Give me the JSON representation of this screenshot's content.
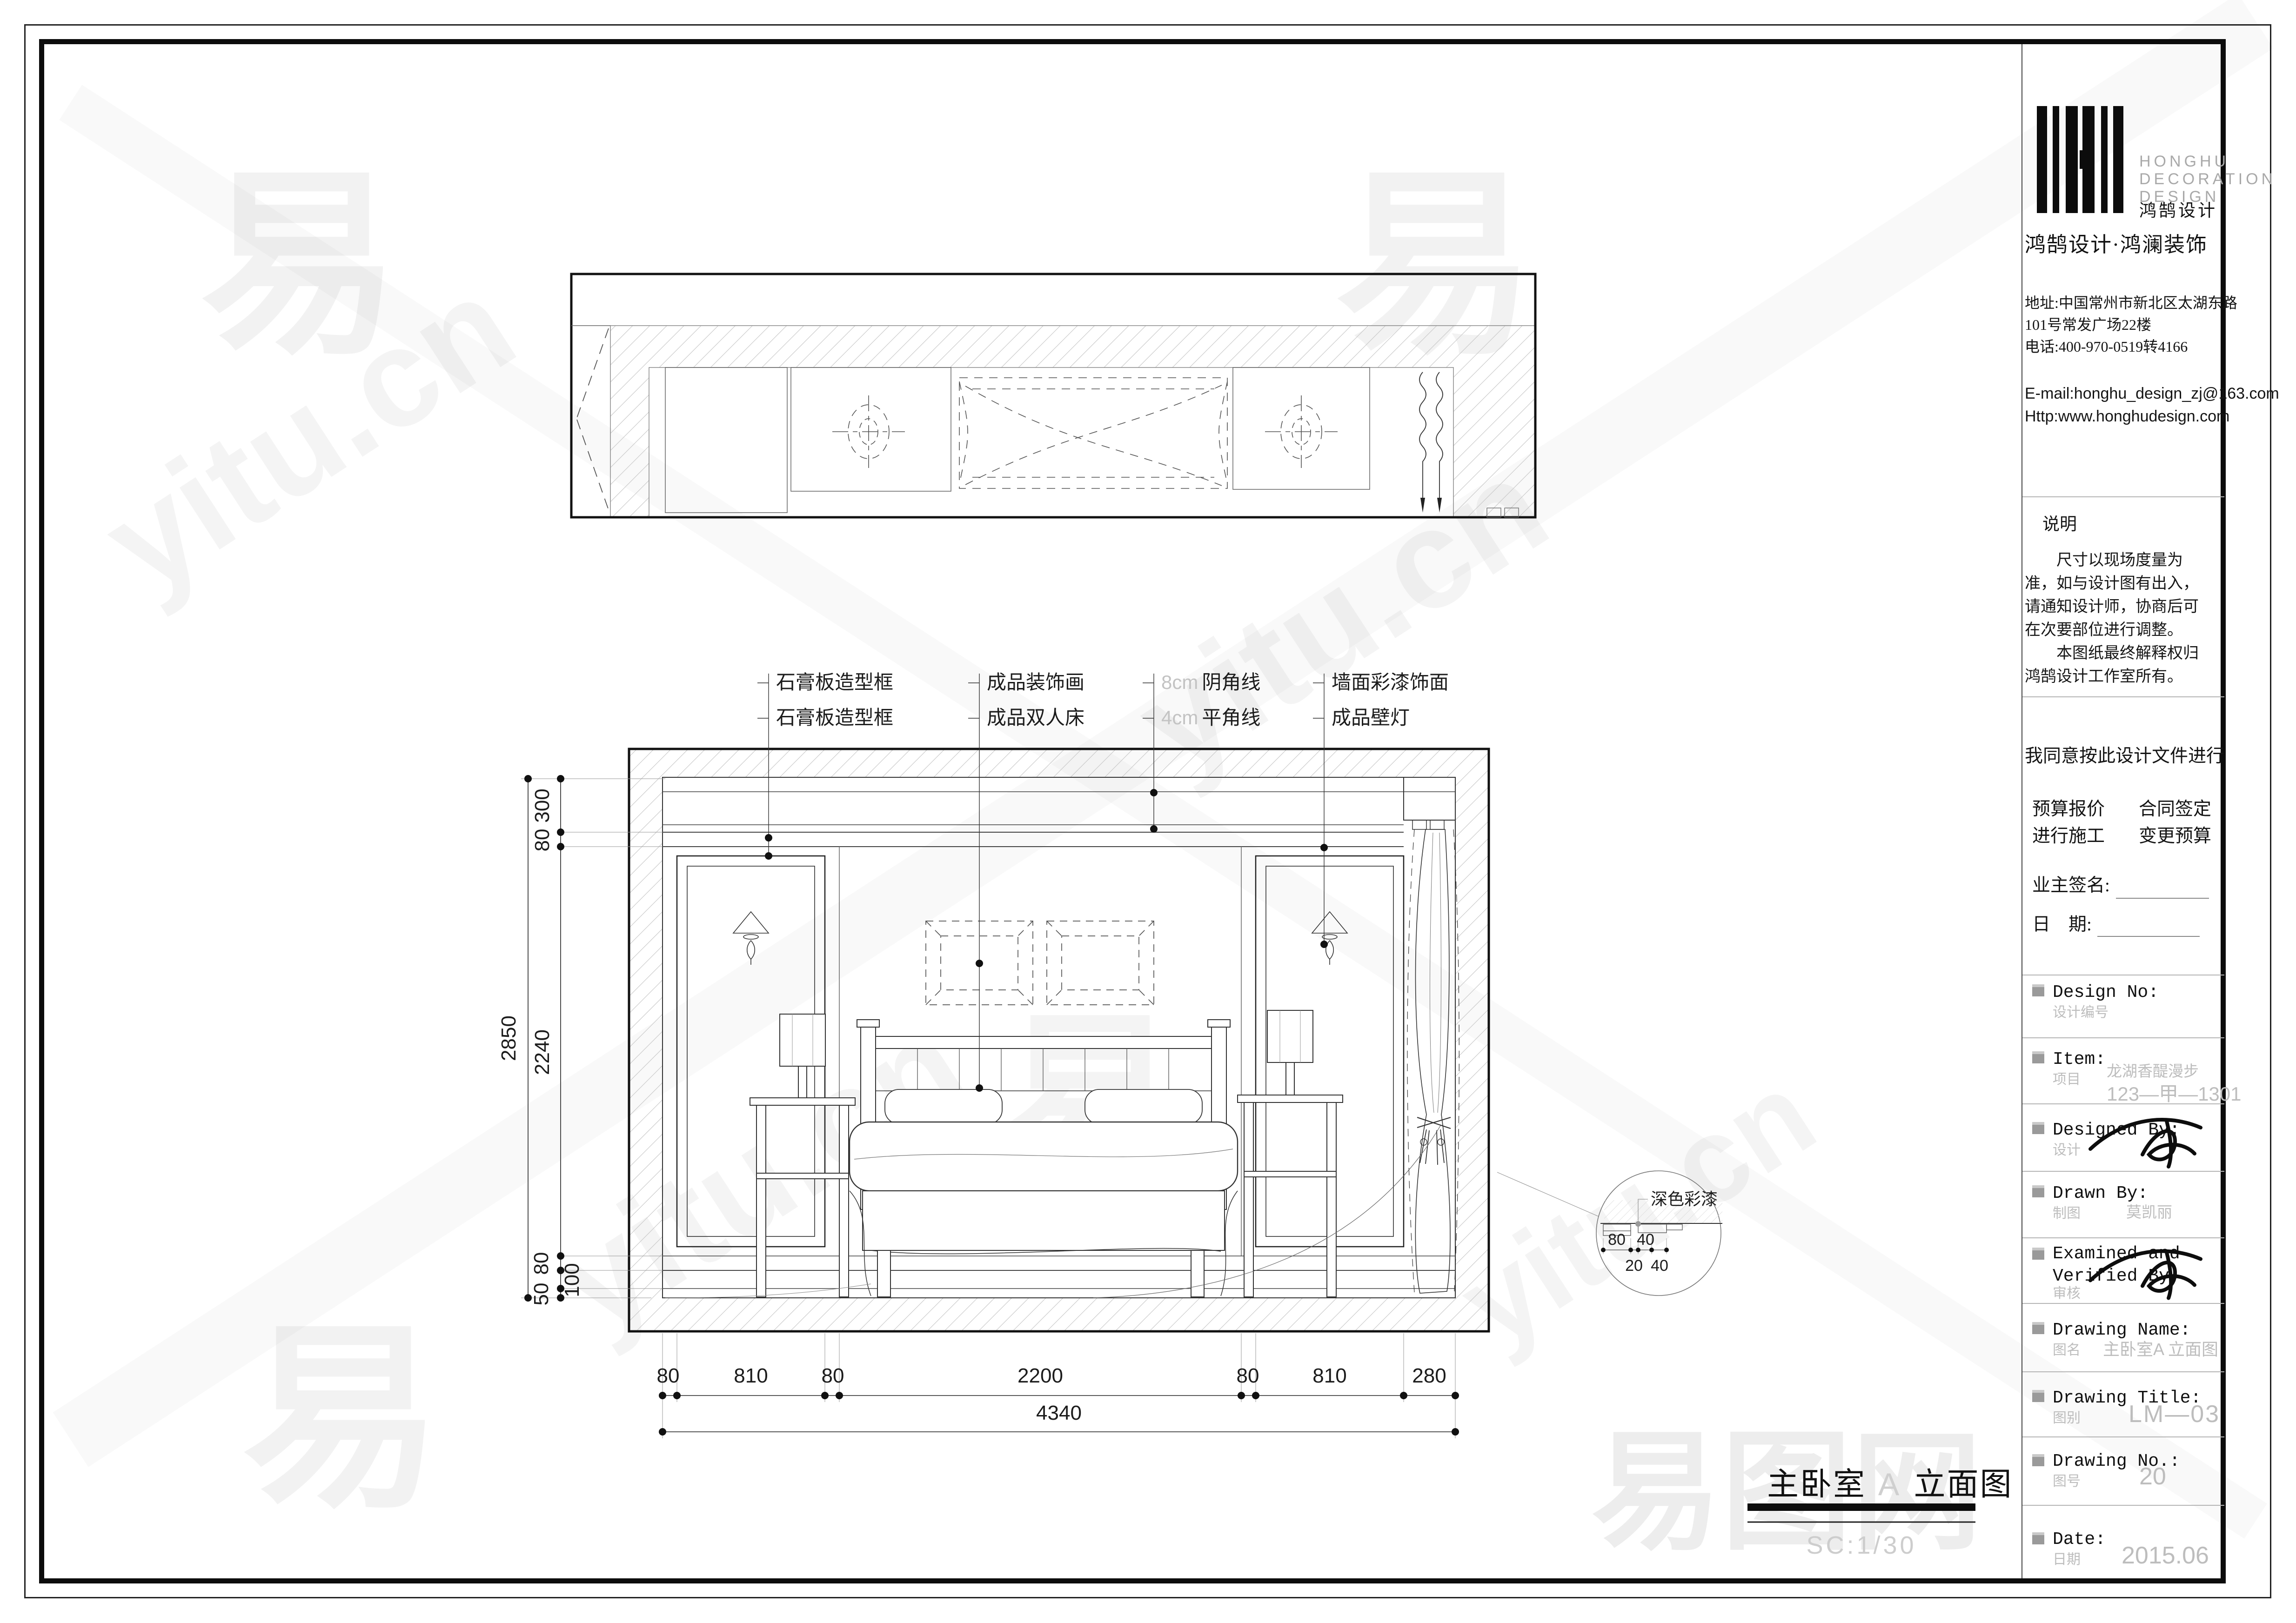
{
  "company": {
    "name_en1": "HONGHU",
    "name_en2": "DECORATION",
    "name_en3": "DESIGN",
    "name_cn": "鸿鹄设计",
    "brand_line": "鸿鹄设计·鸿澜装饰",
    "address1": "地址:中国常州市新北区太湖东路",
    "address2": "101号常发广场22楼",
    "phone": "电话:400-970-0519转4166",
    "email": "E-mail:honghu_design_zj@163.com",
    "website": "Http:www.honghudesign.com"
  },
  "notes": {
    "heading": "说明",
    "para1": "尺寸以现场度量为准，如与设计图有出入，请通知设计师，协商后可在次要部位进行调整。",
    "para2": "本图纸最终解释权归鸿鹄设计工作室所有。"
  },
  "agreement": {
    "line": "我同意按此设计文件进行",
    "opt1": "预算报价",
    "opt2": "合同签定",
    "opt3": "进行施工",
    "opt4": "变更预算",
    "sign_label": "业主签名:",
    "date_label": "日    期:"
  },
  "fields": {
    "design_no": {
      "en": "Design No:",
      "cn": "设计编号"
    },
    "item": {
      "en": "Item:",
      "cn": "项目",
      "value1": "龙湖香醍漫步",
      "value2": "123—甲—1301"
    },
    "designed_by": {
      "en": "Designed By:",
      "cn": "设计"
    },
    "drawn_by": {
      "en": "Drawn By:",
      "cn": "制图",
      "value": "莫凯丽"
    },
    "examined": {
      "en1": "Examined and",
      "en2": "Verified By:",
      "cn": "审核"
    },
    "drawing_name": {
      "en": "Drawing Name:",
      "cn": "图名",
      "value": "主卧室A 立面图"
    },
    "drawing_title": {
      "en": "Drawing Title:",
      "cn": "图别",
      "value": "LM—03"
    },
    "drawing_no": {
      "en": "Drawing No.:",
      "cn": "图号",
      "value": "20"
    },
    "date": {
      "en": "Date:",
      "cn": "日期",
      "value": "2015.06"
    }
  },
  "callouts": {
    "c1a": "石膏板造型框",
    "c1b": "石膏板造型框",
    "c2a": "成品装饰画",
    "c2b": "成品双人床",
    "c3a_prefix": "8cm",
    "c3a": "阴角线",
    "c3b_prefix": "4cm",
    "c3b": "平角线",
    "c4a": "墙面彩漆饰面",
    "c4b": "成品壁灯"
  },
  "dims": {
    "bottom": [
      "80",
      "810",
      "80",
      "2200",
      "80",
      "810",
      "280"
    ],
    "total": "4340",
    "v2850": "2850",
    "v300": "300",
    "v80a": "80",
    "v2240": "2240",
    "v80b": "80",
    "v100": "100",
    "v50": "50"
  },
  "detail": {
    "label": "深色彩漆",
    "a": "80",
    "b": "40",
    "c": "20",
    "d": "40"
  },
  "title": {
    "main": "主卧室",
    "letter": "A",
    "rest": "立面图",
    "scale": "SC:1/30"
  },
  "watermark": {
    "text": "yitu.cn",
    "logo": "易",
    "site": "易图网"
  }
}
